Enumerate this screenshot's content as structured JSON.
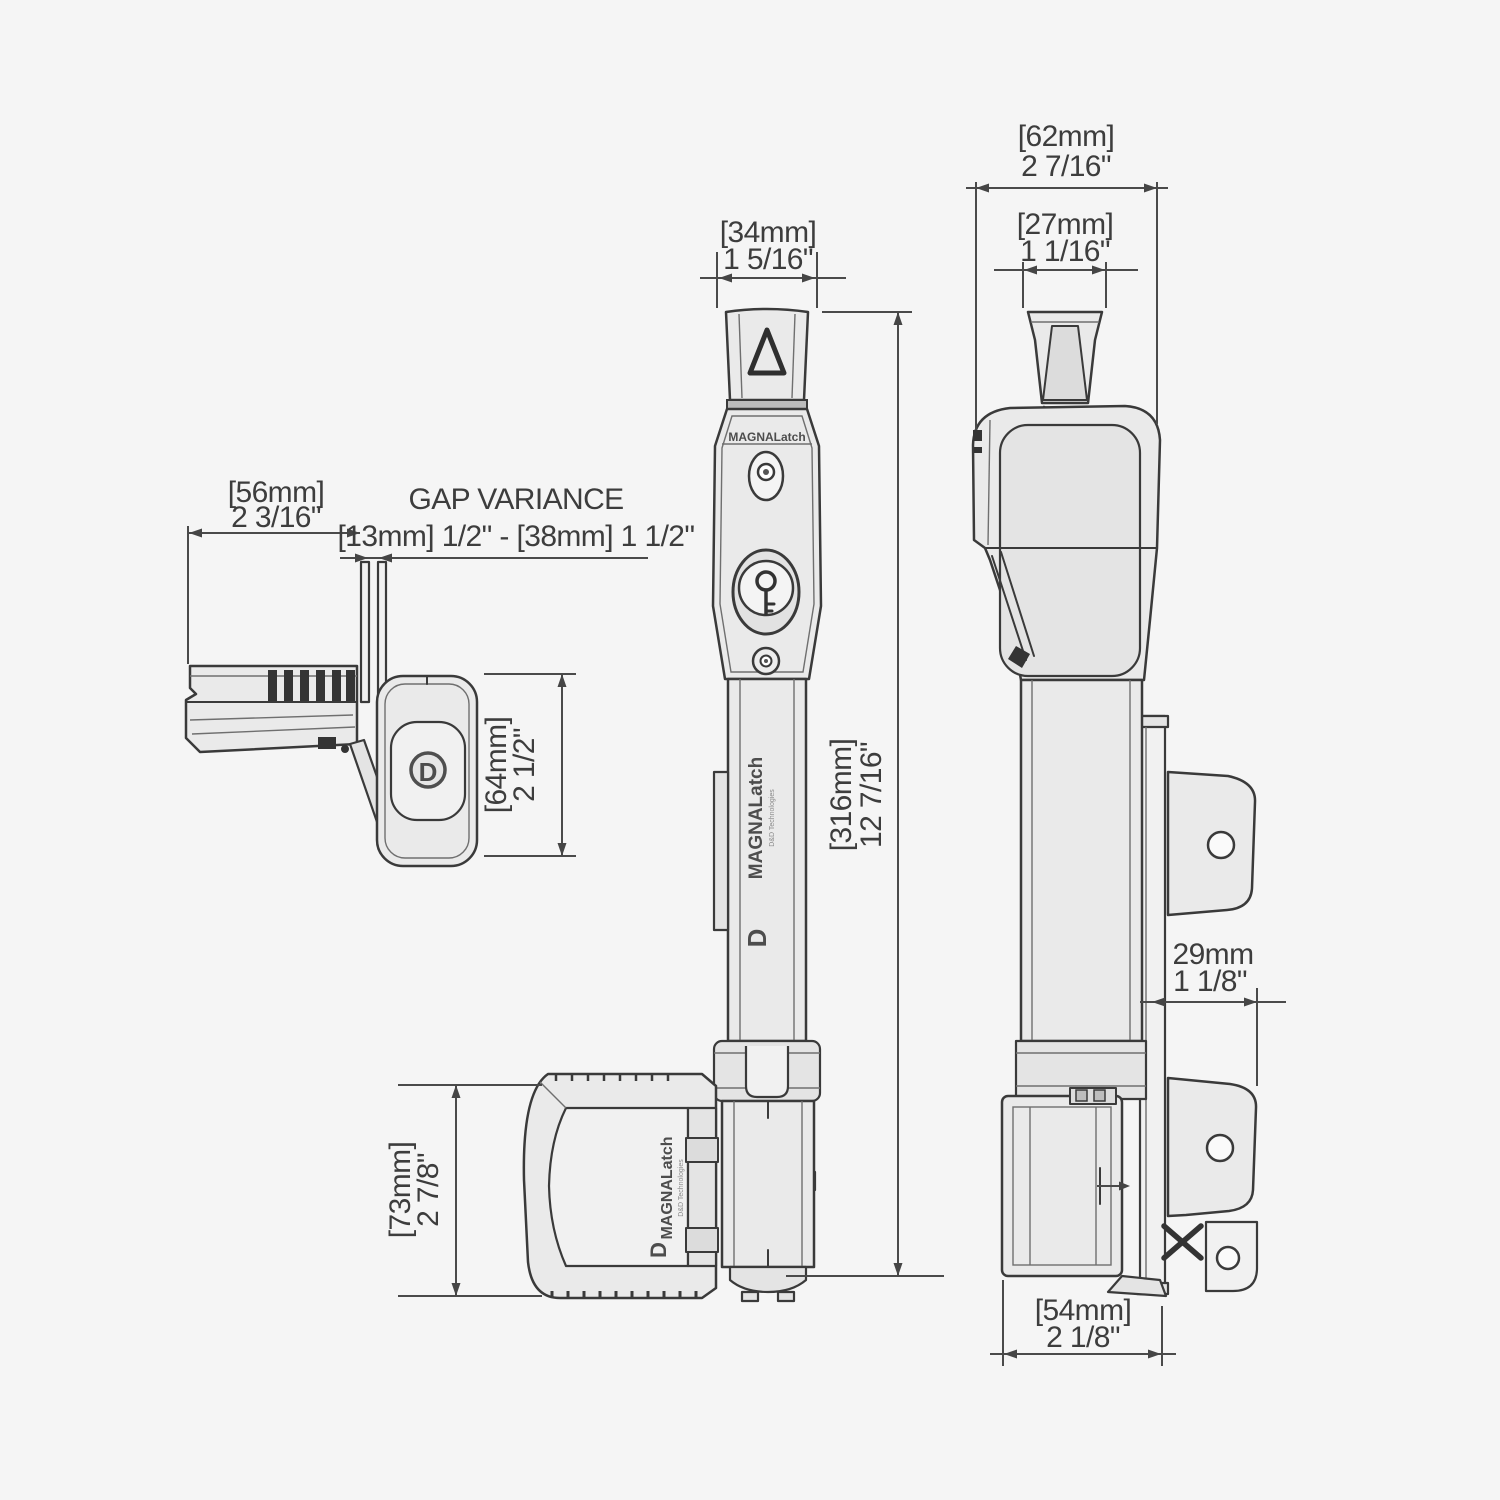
{
  "page": {
    "background": "#f5f5f5",
    "line_color": "#3a3a3a",
    "fill_color": "#eaeaea"
  },
  "drawing": {
    "brand": {
      "name": "MAGNALatch",
      "sub": "D&D Technologies",
      "logo": "D"
    },
    "gap": {
      "title": "GAP VARIANCE",
      "range": "[13mm] 1/2\" - [38mm] 1 1/2\""
    },
    "dims": {
      "top_depth": {
        "mm": "[56mm]",
        "in": "2 3/16\""
      },
      "top_height": {
        "mm": "[64mm]",
        "in": "2 1/2\""
      },
      "front_knob": {
        "mm": "[34mm]",
        "in": "1 5/16\""
      },
      "overall_height": {
        "mm": "[316mm]",
        "in": "12 7/16\""
      },
      "bottom_height": {
        "mm": "[73mm]",
        "in": "2 7/8\""
      },
      "side_overall": {
        "mm": "[62mm]",
        "in": "2 7/16\""
      },
      "side_knob": {
        "mm": "[27mm]",
        "in": "1 1/16\""
      },
      "bracket_gap": {
        "mm": "29mm",
        "in": "1 1/8\""
      },
      "bottom_width": {
        "mm": "[54mm]",
        "in": "2 1/8\""
      }
    }
  }
}
